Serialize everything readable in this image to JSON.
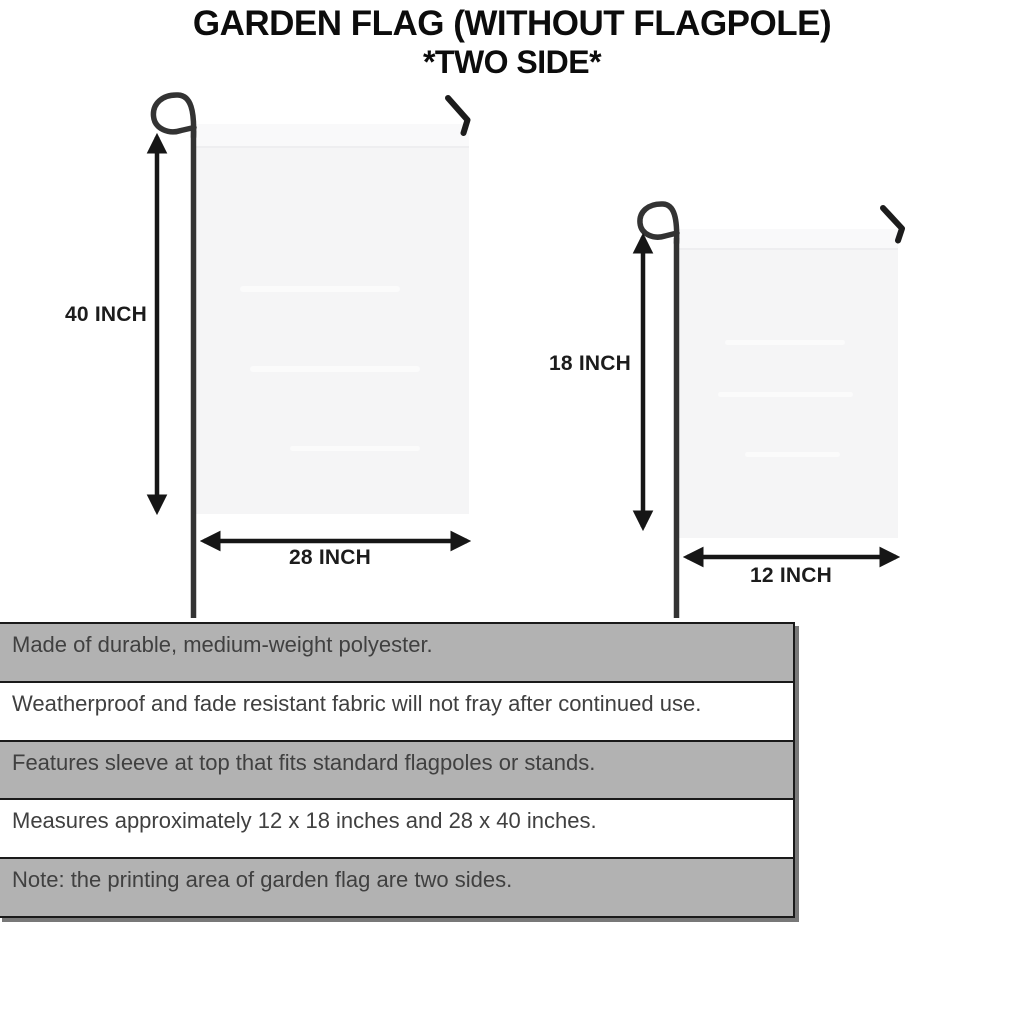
{
  "title": {
    "line1": "GARDEN FLAG (WITHOUT FLAGPOLE)",
    "line2": "*TWO SIDE*"
  },
  "flags": {
    "large": {
      "height_label": "40 INCH",
      "width_label": "28 INCH"
    },
    "small": {
      "height_label": "18 INCH",
      "width_label": "12 INCH"
    }
  },
  "features": {
    "rows": [
      {
        "text": "Made of durable, medium-weight polyester."
      },
      {
        "text": "Weatherproof and fade resistant fabric will not fray after continued use."
      },
      {
        "text": "Features sleeve at top that fits standard flagpoles or stands."
      },
      {
        "text": "Measures approximately 12 x 18 inches and 28 x 40 inches."
      },
      {
        "text": "Note: the printing area of garden flag are two sides."
      }
    ]
  },
  "colors": {
    "row_shaded": "#b2b2b2",
    "row_plain": "#ffffff",
    "table_border": "#1a1a1a",
    "body_text": "#404040",
    "title_text": "#0c0c0c",
    "flag_fill": "#f5f5f6",
    "pole": "#333333",
    "arrow": "#161616"
  }
}
